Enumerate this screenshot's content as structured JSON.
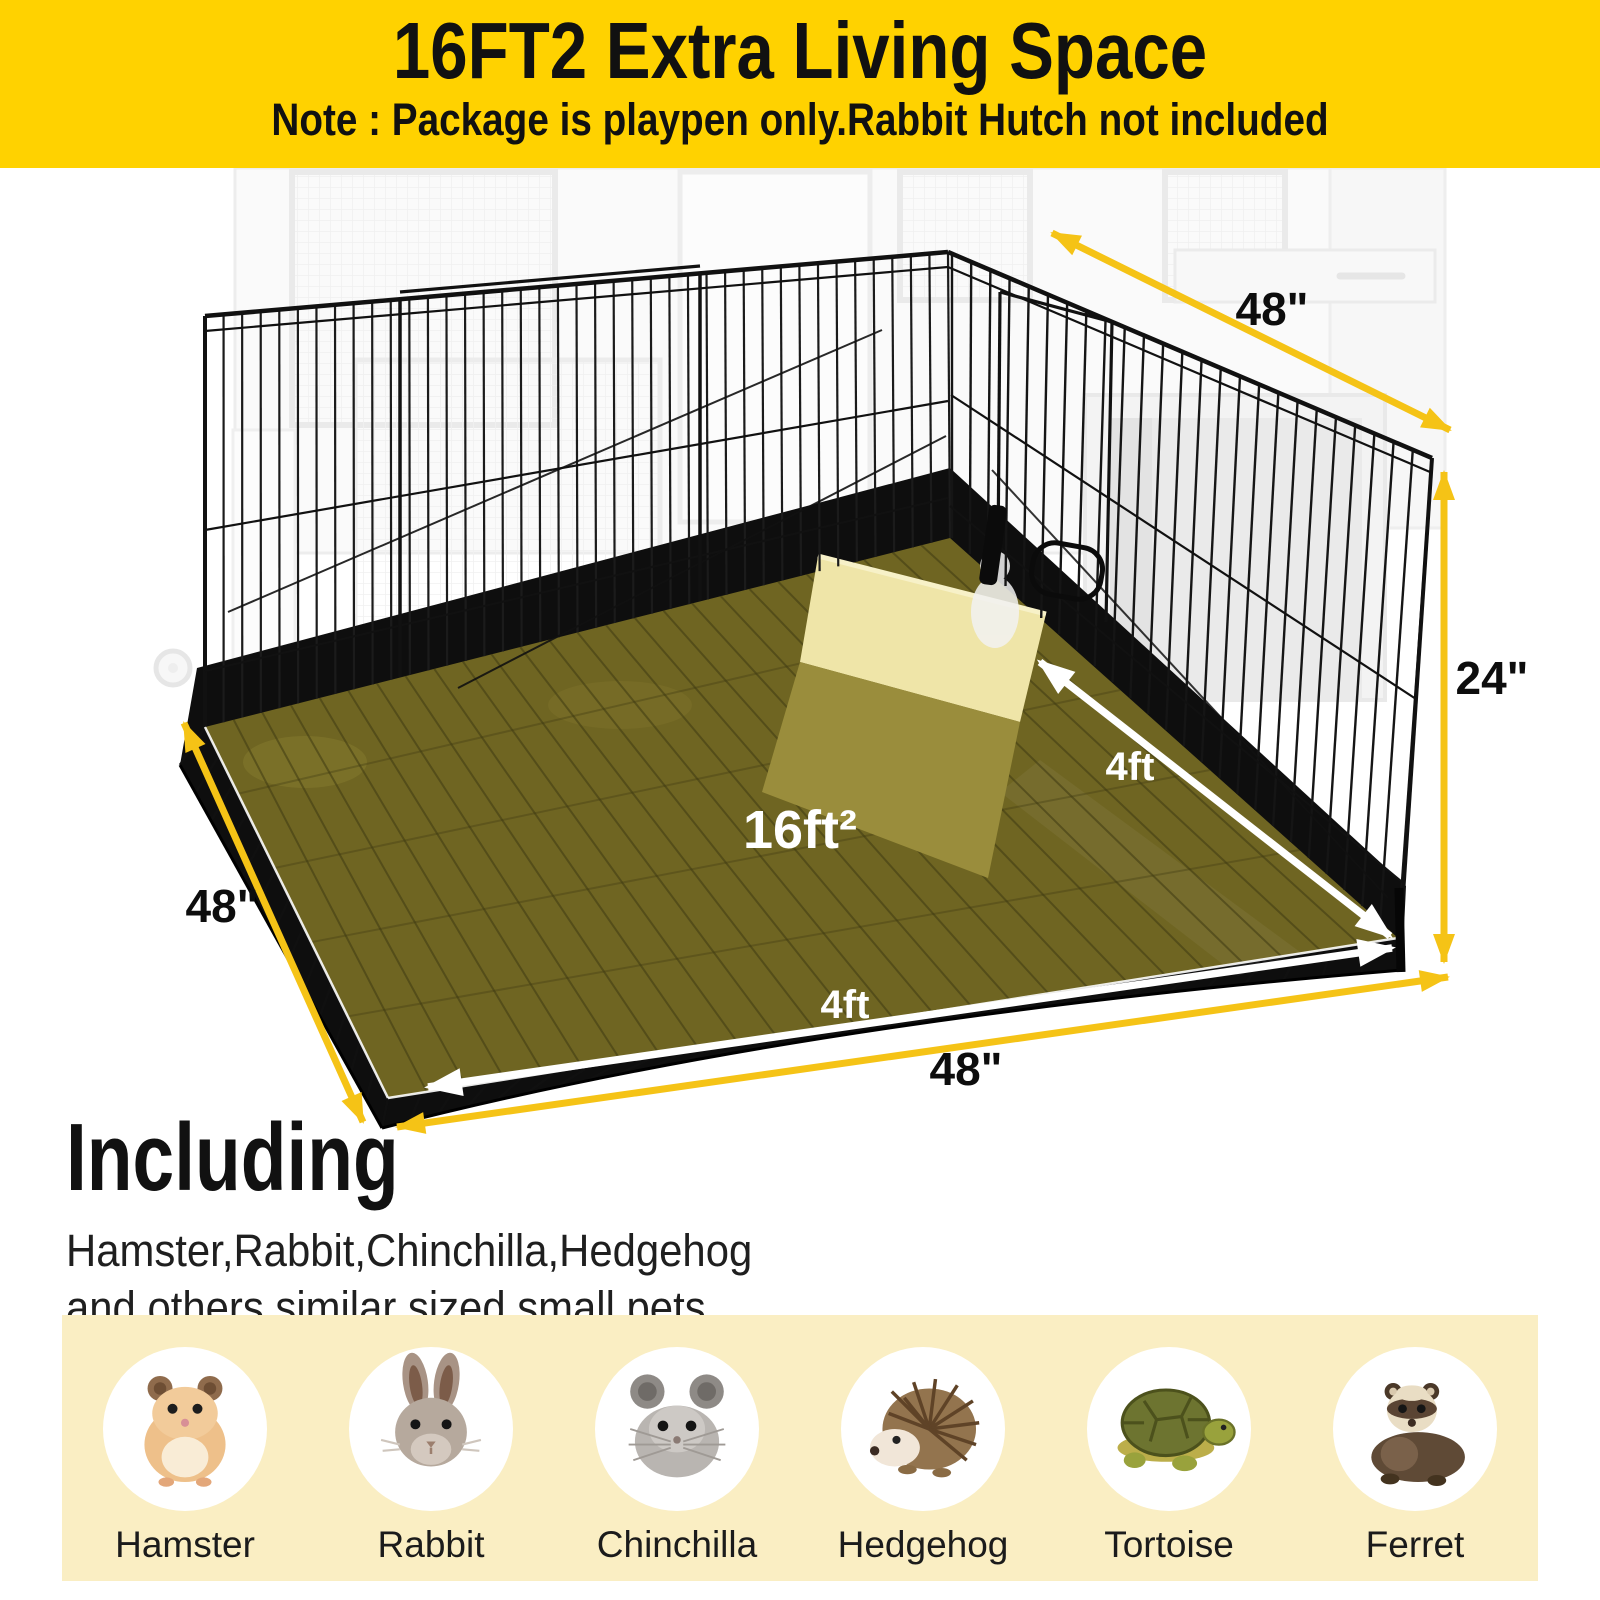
{
  "header": {
    "title": "16FT2 Extra Living Space",
    "note": "Note : Package is playpen only.Rabbit Hutch not included"
  },
  "diagram": {
    "area_label": "16ft²",
    "dims": {
      "top_width": "48\"",
      "right_height": "24\"",
      "left_depth": "48\"",
      "bottom_width": "48\"",
      "floor_depth": "4ft",
      "floor_width": "4ft"
    }
  },
  "including": {
    "heading": "Including",
    "line1": "Hamster,Rabbit,Chinchilla,Hedgehog",
    "line2": "and others similar sized small pets"
  },
  "pets": [
    {
      "name": "Hamster",
      "icon": "hamster-image"
    },
    {
      "name": "Rabbit",
      "icon": "rabbit-image"
    },
    {
      "name": "Chinchilla",
      "icon": "chinchilla-image"
    },
    {
      "name": "Hedgehog",
      "icon": "hedgehog-image"
    },
    {
      "name": "Tortoise",
      "icon": "tortoise-image"
    },
    {
      "name": "Ferret",
      "icon": "ferret-image"
    }
  ],
  "colors": {
    "header_bg": "#FFD200",
    "arrow_gold": "#F5C316",
    "floor_highlight": "#6F6522",
    "panel_bg": "#FAEEC3",
    "wire_black": "#151515",
    "white": "#FFFFFF"
  }
}
